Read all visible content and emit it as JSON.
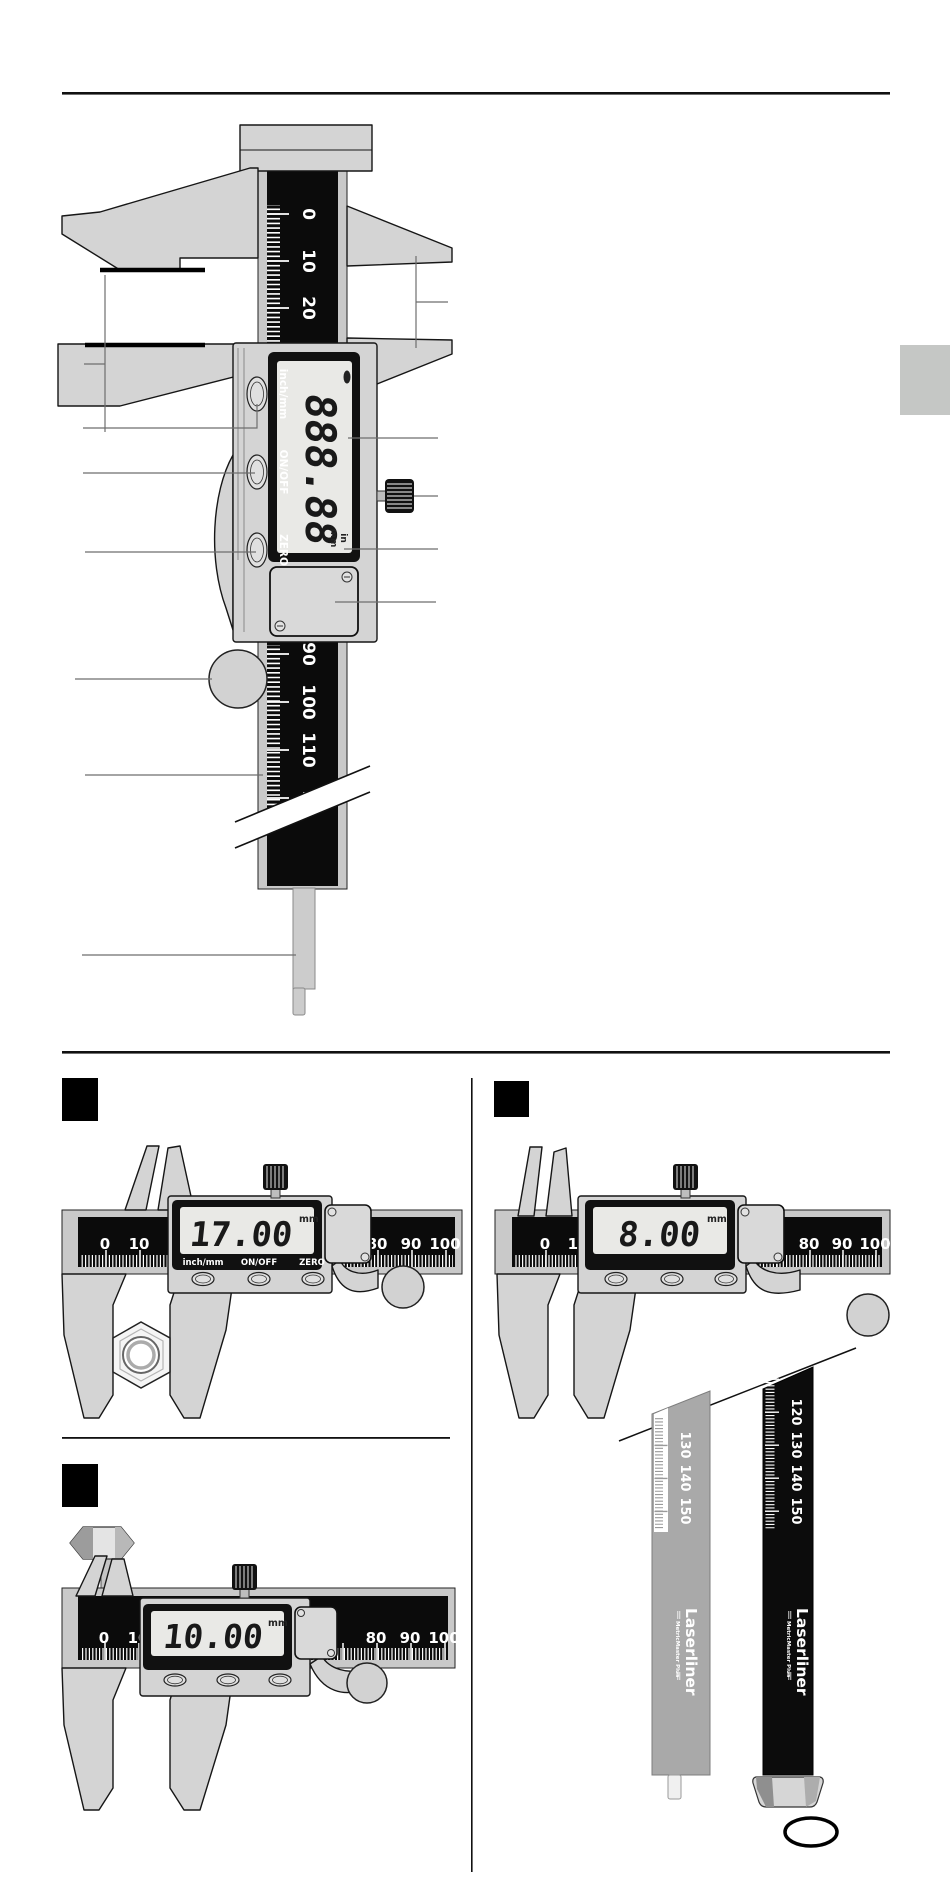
{
  "page": {
    "background": "#ffffff",
    "beam_black": "#0b0b0b",
    "metal_gray": "#d4d4d4",
    "tab_gray": "#c5c7c5"
  },
  "main": {
    "upper_scale": [
      "0",
      "10",
      "20"
    ],
    "lower_scale": [
      "90",
      "100",
      "110"
    ],
    "break_digit": "1",
    "lcd": {
      "value": "888.88",
      "units_in": "in",
      "units_mm": "mm"
    },
    "buttons": {
      "inch_mm": "inch/mm",
      "on_off": "ON/OFF",
      "zero": "ZERO"
    }
  },
  "ex1": {
    "lcd_value": "17.00",
    "lcd_unit": "mm",
    "labels": {
      "inch_mm": "inch/mm",
      "on_off": "ON/OFF",
      "zero": "ZERO"
    },
    "scale": {
      "n0": "0",
      "n10": "10",
      "n80": "80",
      "n90": "90",
      "n100": "100"
    }
  },
  "ex2": {
    "lcd_value": "8.00",
    "lcd_unit": "mm",
    "scale": {
      "n0": "0",
      "n10": "10",
      "n80": "80",
      "n90": "90",
      "n100": "100"
    }
  },
  "ex3": {
    "lcd_value": "10.00",
    "lcd_unit": "mm",
    "scale": {
      "n0": "0",
      "n10": "10",
      "n80": "80",
      "n90": "90",
      "n100": "100"
    }
  },
  "ex4": {
    "brand": "Laserliner",
    "product": "MetricMaster Plus",
    "gray_scale": [
      "130",
      "140",
      "150"
    ],
    "black_scale": [
      "120",
      "130",
      "140",
      "150"
    ]
  }
}
